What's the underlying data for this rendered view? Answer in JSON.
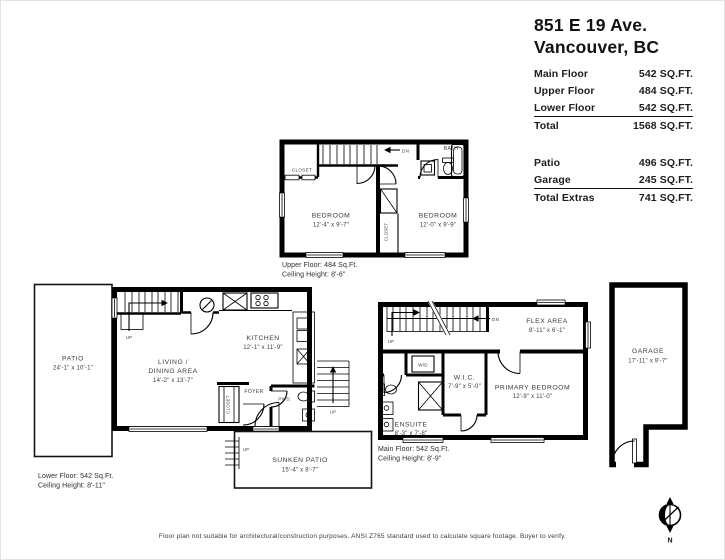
{
  "header": {
    "address_line1": "851 E 19 Ave.",
    "address_line2": "Vancouver, BC"
  },
  "area_table": {
    "rows": [
      {
        "label": "Main Floor",
        "value": "542 SQ.FT."
      },
      {
        "label": "Upper Floor",
        "value": "484 SQ.FT."
      },
      {
        "label": "Lower Floor",
        "value": "542 SQ.FT."
      }
    ],
    "total": {
      "label": "Total",
      "value": "1568 SQ.FT."
    },
    "extra_rows": [
      {
        "label": "Patio",
        "value": "496 SQ.FT."
      },
      {
        "label": "Garage",
        "value": "245 SQ.FT."
      }
    ],
    "total_extras": {
      "label": "Total Extras",
      "value": "741 SQ.FT."
    }
  },
  "upper_floor": {
    "caption_line1": "Upper Floor: 484 Sq.Ft.",
    "caption_line2": "Ceiling Height: 8'-6\"",
    "stairs_dn_label": "DN",
    "closet_label": "CLOSET",
    "closet_vertical_label": "CLOSET",
    "bath_label": "BATH",
    "bedroom_left": {
      "name": "BEDROOM",
      "dims": "12'-4\" x 9'-7\""
    },
    "bedroom_right": {
      "name": "BEDROOM",
      "dims": "12'-0\" x 9'-9\""
    }
  },
  "lower_floor": {
    "caption_line1": "Lower Floor: 542 Sq.Ft.",
    "caption_line2": "Ceiling Height: 8'-11\"",
    "patio": {
      "name": "PATIO",
      "dims": "24'-1\" x 10'-1\""
    },
    "living_dining": {
      "line1": "LIVING /",
      "line2": "DINING AREA",
      "dims": "14'-2\" x 13'-7\""
    },
    "kitchen": {
      "name": "KITCHEN",
      "dims": "12'-1\" x 11'-9\""
    },
    "foyer_label": "FOYER",
    "powder_label": "PWD.",
    "closet_vertical_label": "CLOSET",
    "stairs_up_label": "UP",
    "exterior_stairs_up_label": "UP",
    "sunken_patio": {
      "name": "SUNKEN PATIO",
      "dims": "15'-4\" x 8'-7\"",
      "stairs_up_label": "UP"
    }
  },
  "main_floor": {
    "caption_line1": "Main Floor: 542 Sq.Ft.",
    "caption_line2": "Ceiling Height: 8'-9\"",
    "stairs_up_label": "UP",
    "stairs_dn_label": "DN",
    "flex_area": {
      "name": "FLEX AREA",
      "dims": "8'-11\" x 6'-1\""
    },
    "washer_dryer_label": "W/D",
    "wic": {
      "name": "W.I.C.",
      "dims": "7'-9\" x 5'-0\""
    },
    "primary_bedroom": {
      "name": "PRIMARY BEDROOM",
      "dims": "12'-9\" x 11'-0\""
    },
    "ensuite": {
      "name": "ENSUITE",
      "dims": "8'-3\" x 7'-8\""
    }
  },
  "garage": {
    "name": "GARAGE",
    "dims": "17'-11\" x 9'-7\""
  },
  "compass": {
    "label": "N"
  },
  "disclaimer": "Floor plan not suitable for architectural/construction purposes. ANSI Z765 standard used to calculate square footage. Buyer to verify."
}
